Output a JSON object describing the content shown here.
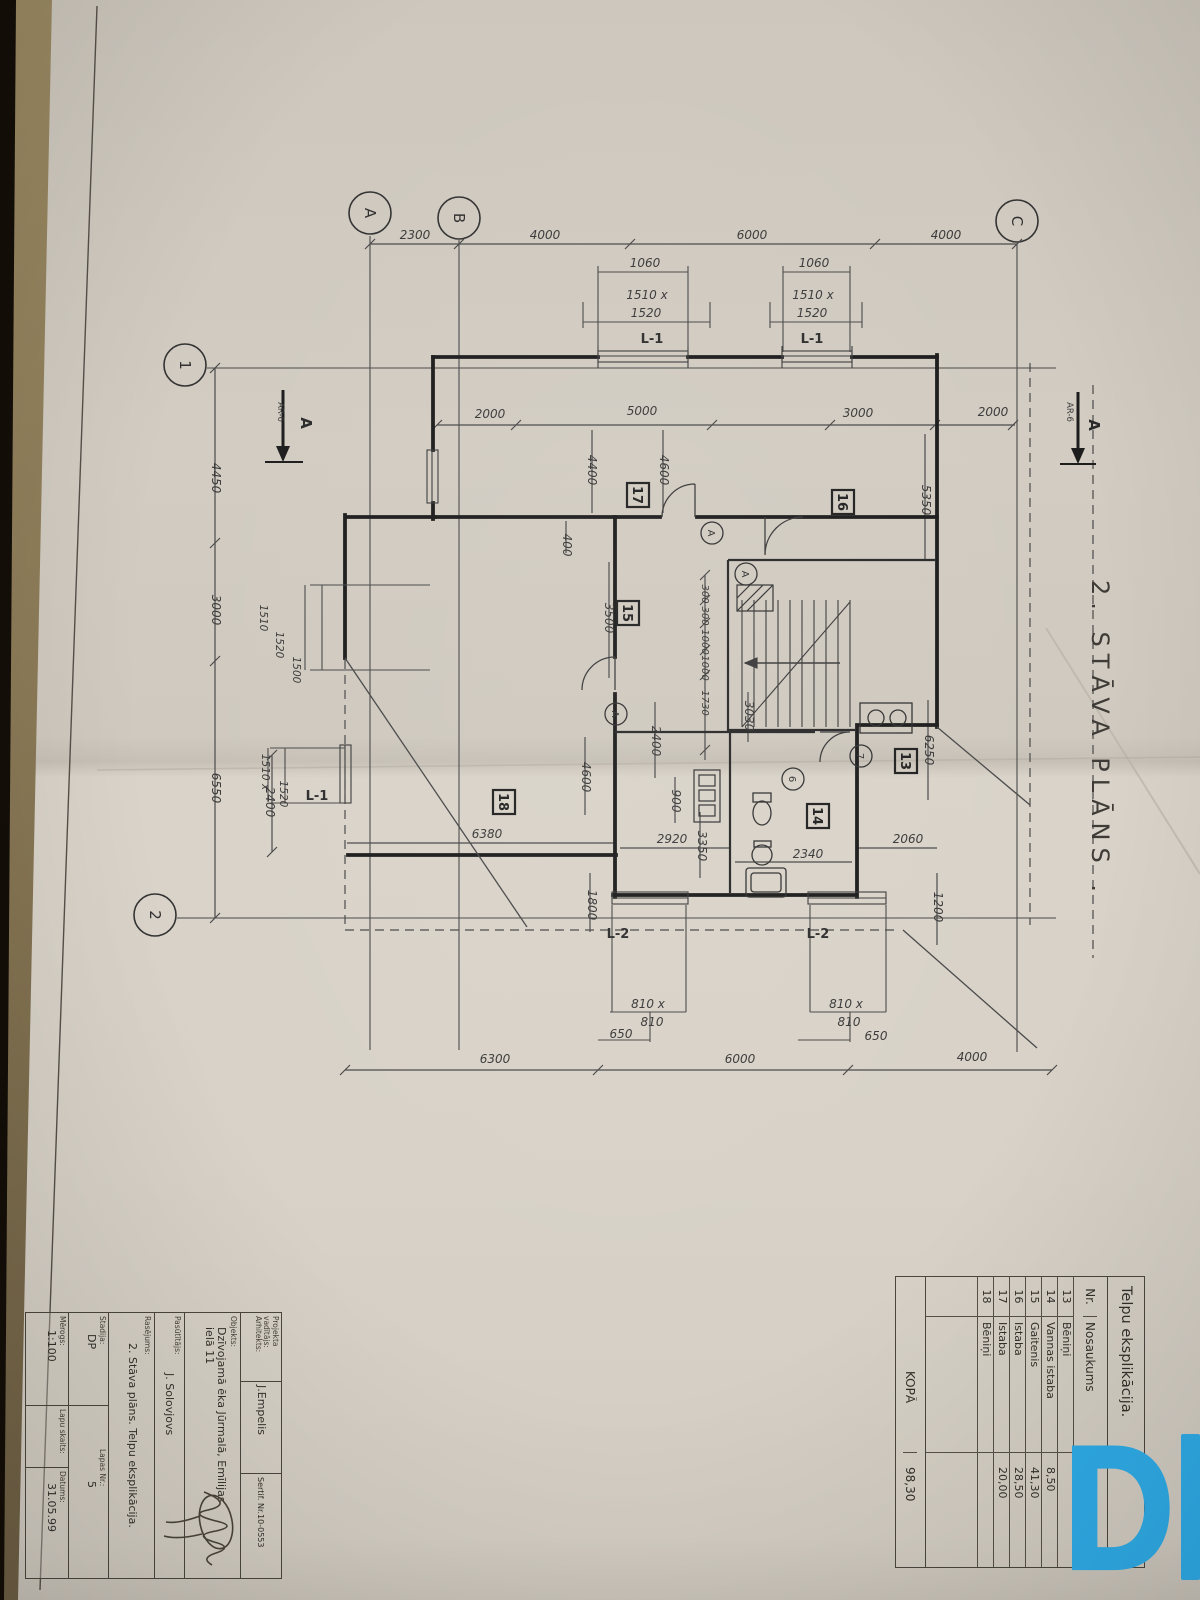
{
  "plan": {
    "title": "2. STĀVA PLĀNS .",
    "axes": {
      "a": "A",
      "b": "B",
      "c": "C",
      "n1": "1",
      "n2": "2"
    },
    "section": {
      "label": "A",
      "ref": "AR-6"
    },
    "dims": {
      "top": [
        "2300",
        "4000",
        "6000",
        "4000"
      ],
      "left": [
        "4450",
        "3000",
        "6550",
        "2400"
      ],
      "bottom": [
        "6300",
        "6000",
        "4000"
      ],
      "inner_top": [
        "2000",
        "5000",
        "3000",
        "2000"
      ],
      "v": [
        "4400",
        "4600",
        "400",
        "3500",
        "4600",
        "5350",
        "6250",
        "2400",
        "3030",
        "900",
        "3350",
        "1800",
        "1200"
      ],
      "small": [
        "300",
        "300",
        "1000",
        "1000",
        "1730"
      ],
      "h": [
        "6380",
        "2920",
        "2340",
        "2060"
      ]
    },
    "windows": {
      "top1": {
        "w": "1060",
        "s1": "1510 x",
        "s2": "1520",
        "mark": "L-1"
      },
      "top2": {
        "w": "1060",
        "s1": "1510 x",
        "s2": "1520",
        "mark": "L-1"
      },
      "left1": {
        "s1": "1510",
        "s2": "1520",
        "s3": "1500"
      },
      "left2": {
        "s1": "1510 x",
        "s2": "1520",
        "mark": "L-1"
      },
      "bot1": {
        "s1": "810 x",
        "s2": "810",
        "off": "650",
        "mark": "L-2"
      },
      "bot2": {
        "s1": "810 x",
        "s2": "810",
        "off": "650",
        "mark": "L-2"
      }
    },
    "rooms": {
      "r13": "13",
      "r14": "14",
      "r15": "15",
      "r16": "16",
      "r17": "17",
      "r18": "18"
    },
    "tags": {
      "a": "A",
      "n6": "6",
      "n7": "7"
    }
  },
  "explication": {
    "title": "Telpu eksplikācija.",
    "columns": {
      "nr": "Nr.",
      "name": "Nosaukums",
      "area": "m²"
    },
    "rows": [
      {
        "nr": "13",
        "name": "Bēniņi",
        "area": ""
      },
      {
        "nr": "14",
        "name": "Vannas istaba",
        "area": "8,50"
      },
      {
        "nr": "15",
        "name": "Gaitenis",
        "area": "41,30"
      },
      {
        "nr": "16",
        "name": "Istaba",
        "area": "28,50"
      },
      {
        "nr": "17",
        "name": "Istaba",
        "area": "20,00"
      },
      {
        "nr": "18",
        "name": "Bēniņi",
        "area": ""
      }
    ],
    "total": {
      "label": "KOPĀ",
      "area": "98,30"
    }
  },
  "titleblock": {
    "row1": {
      "label1": "Projekta",
      "label2": "vadītājs:",
      "label3": "Arhitekts:",
      "value": "J.Empelis",
      "cert": "Sertif. Nr.10-0553"
    },
    "objekts": {
      "label": "Objekts:",
      "value": "Dzīvojamā ēka Jūrmalā, Emīlijas ielā 11"
    },
    "pasutitajs": {
      "label": "Pasūtītājs:",
      "value": "J. Solovjovs"
    },
    "rasejums": {
      "label": "Rasējums:",
      "value": "2. Stāva plāns. Telpu eksplikācija."
    },
    "stadija": {
      "label": "Stadija:",
      "value": "DP"
    },
    "lapas": {
      "label": "Lapas Nr.:",
      "value": "5"
    },
    "merogs": {
      "label": "Mērogs:",
      "value": "1:100"
    },
    "lapu": {
      "label": "Lapu skaits:",
      "value": ""
    },
    "datums": {
      "label": "Datums:",
      "value": "31.05.99"
    }
  },
  "watermark": {
    "letter": "D",
    "color": "#2fade9"
  }
}
